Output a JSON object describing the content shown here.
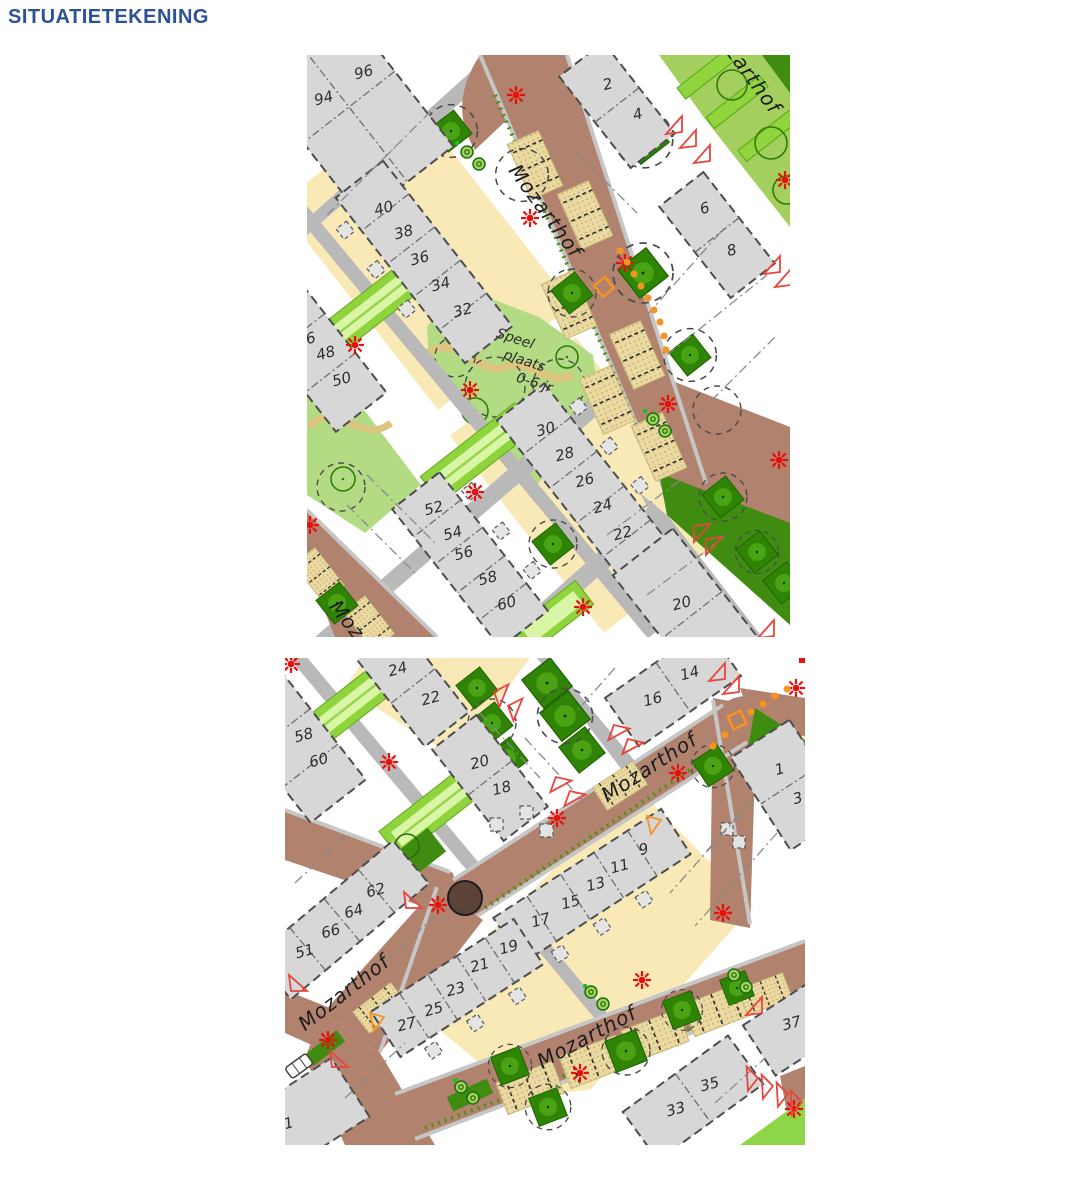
{
  "page": {
    "title": "SITUATIETEKENING"
  },
  "colors": {
    "title_blue": "#2b5197",
    "road_brown": "#b1826d",
    "street_gray": "#b9b9b9",
    "house_gray": "#d7d7d7",
    "lot_yellow": "#f8e9b7",
    "green_light": "#b2db84",
    "green_strip": "#90d43e",
    "green_dark": "#3f8c10",
    "parking_beige": "#ead9a2",
    "lamp_red": "#e8100c",
    "marker_orange": "#f59323",
    "turn_circle_brown": "#5d4238"
  },
  "legend_symbols": [
    "street-lamp-icon",
    "tree-icon",
    "tree-canopy-icon",
    "entrance-triangle-icon",
    "bicycle-stand-icon",
    "utility-square-icon",
    "parking-bay",
    "car-icon"
  ],
  "map_north": {
    "street_labels": [
      {
        "text": "Mozarthof",
        "x": 233,
        "y": 160,
        "rot": 54
      },
      {
        "text": "Mozarthof",
        "x": 432,
        "y": 16,
        "rot": 54
      },
      {
        "text": "Mozarthof",
        "x": 55,
        "y": 595,
        "rot": 52
      }
    ],
    "area_labels": [
      {
        "text": "Speel",
        "x": 207,
        "y": 288,
        "rot": 18
      },
      {
        "text": "plaats",
        "x": 216,
        "y": 310,
        "rot": 18
      },
      {
        "text": "0-6 jr",
        "x": 226,
        "y": 332,
        "rot": 18
      }
    ],
    "house_numbers": [
      {
        "n": "96",
        "x": 58,
        "y": 22,
        "rot": -15
      },
      {
        "n": "94",
        "x": 18,
        "y": 48,
        "rot": -15
      },
      {
        "n": "40",
        "x": 78,
        "y": 158,
        "rot": -15
      },
      {
        "n": "38",
        "x": 98,
        "y": 182,
        "rot": -15
      },
      {
        "n": "36",
        "x": 114,
        "y": 208,
        "rot": -15
      },
      {
        "n": "34",
        "x": 135,
        "y": 234,
        "rot": -15
      },
      {
        "n": "32",
        "x": 157,
        "y": 260,
        "rot": -15
      },
      {
        "n": "6",
        "x": 5,
        "y": 288,
        "rot": -15
      },
      {
        "n": "48",
        "x": 20,
        "y": 303,
        "rot": -15
      },
      {
        "n": "50",
        "x": 36,
        "y": 329,
        "rot": -15
      },
      {
        "n": "30",
        "x": 240,
        "y": 379,
        "rot": -15
      },
      {
        "n": "28",
        "x": 259,
        "y": 404,
        "rot": -15
      },
      {
        "n": "26",
        "x": 279,
        "y": 430,
        "rot": -15
      },
      {
        "n": "24",
        "x": 297,
        "y": 456,
        "rot": -15
      },
      {
        "n": "22",
        "x": 317,
        "y": 483,
        "rot": -15
      },
      {
        "n": "52",
        "x": 128,
        "y": 458,
        "rot": -15
      },
      {
        "n": "54",
        "x": 147,
        "y": 483,
        "rot": -15
      },
      {
        "n": "56",
        "x": 158,
        "y": 503,
        "rot": -15
      },
      {
        "n": "58",
        "x": 182,
        "y": 528,
        "rot": -15
      },
      {
        "n": "60",
        "x": 201,
        "y": 553,
        "rot": -15
      },
      {
        "n": "20",
        "x": 376,
        "y": 553,
        "rot": -15
      },
      {
        "n": "2",
        "x": 302,
        "y": 34,
        "rot": -15
      },
      {
        "n": "4",
        "x": 332,
        "y": 64,
        "rot": -15
      },
      {
        "n": "6",
        "x": 399,
        "y": 158,
        "rot": -15
      },
      {
        "n": "8",
        "x": 426,
        "y": 200,
        "rot": -15
      }
    ]
  },
  "map_south": {
    "street_labels": [
      {
        "text": "Mozarthof",
        "x": 368,
        "y": 115,
        "rot": -33
      },
      {
        "text": "Mozarthof",
        "x": 63,
        "y": 340,
        "rot": -38
      },
      {
        "text": "Mozarthof",
        "x": 305,
        "y": 385,
        "rot": -28
      }
    ],
    "area_labels": [],
    "house_numbers": [
      {
        "n": "24",
        "x": 114,
        "y": 16,
        "rot": -15
      },
      {
        "n": "22",
        "x": 147,
        "y": 45,
        "rot": -15
      },
      {
        "n": "58",
        "x": 20,
        "y": 82,
        "rot": -15
      },
      {
        "n": "60",
        "x": 35,
        "y": 107,
        "rot": -15
      },
      {
        "n": "20",
        "x": 196,
        "y": 109,
        "rot": -15
      },
      {
        "n": "18",
        "x": 218,
        "y": 135,
        "rot": -15
      },
      {
        "n": "14",
        "x": 406,
        "y": 20,
        "rot": -15
      },
      {
        "n": "16",
        "x": 369,
        "y": 46,
        "rot": -15
      },
      {
        "n": "1",
        "x": 496,
        "y": 116,
        "rot": -15
      },
      {
        "n": "3",
        "x": 514,
        "y": 145,
        "rot": -15
      },
      {
        "n": "9",
        "x": 360,
        "y": 196,
        "rot": -15
      },
      {
        "n": "11",
        "x": 336,
        "y": 213,
        "rot": -15
      },
      {
        "n": "13",
        "x": 312,
        "y": 231,
        "rot": -15
      },
      {
        "n": "15",
        "x": 287,
        "y": 249,
        "rot": -15
      },
      {
        "n": "17",
        "x": 257,
        "y": 267,
        "rot": -15
      },
      {
        "n": "19",
        "x": 225,
        "y": 294,
        "rot": -15
      },
      {
        "n": "21",
        "x": 196,
        "y": 312,
        "rot": -15
      },
      {
        "n": "23",
        "x": 172,
        "y": 336,
        "rot": -15
      },
      {
        "n": "25",
        "x": 150,
        "y": 356,
        "rot": -15
      },
      {
        "n": "27",
        "x": 123,
        "y": 371,
        "rot": -15
      },
      {
        "n": "62",
        "x": 92,
        "y": 237,
        "rot": -15
      },
      {
        "n": "64",
        "x": 70,
        "y": 258,
        "rot": -15
      },
      {
        "n": "66",
        "x": 47,
        "y": 278,
        "rot": -15
      },
      {
        "n": "51",
        "x": 21,
        "y": 298,
        "rot": -15
      },
      {
        "n": "37",
        "x": 508,
        "y": 370,
        "rot": -15
      },
      {
        "n": "35",
        "x": 426,
        "y": 431,
        "rot": -15
      },
      {
        "n": "33",
        "x": 392,
        "y": 456,
        "rot": -15
      },
      {
        "n": "1",
        "x": 5,
        "y": 470,
        "rot": -15
      }
    ]
  }
}
